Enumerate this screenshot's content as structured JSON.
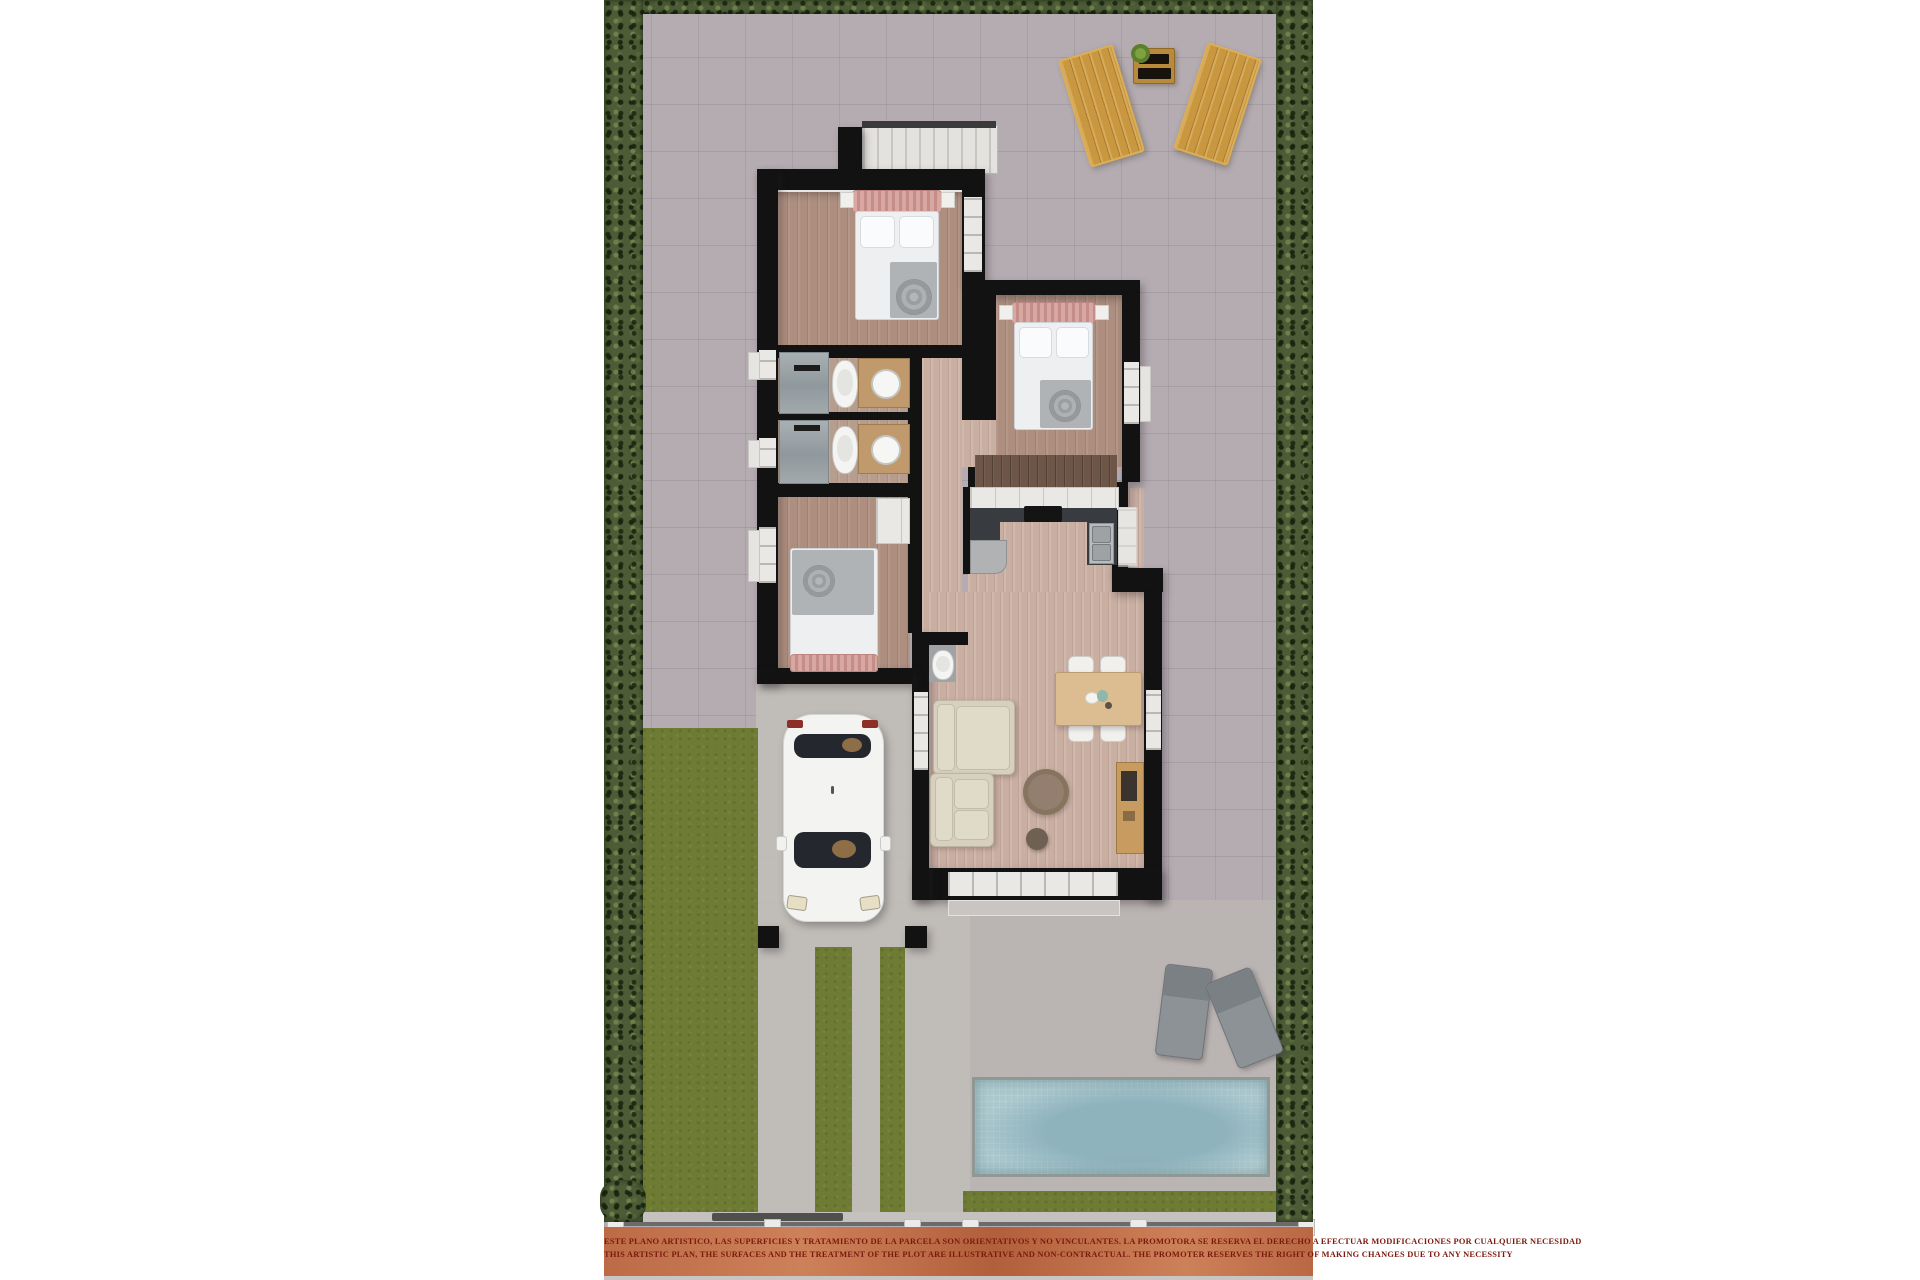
{
  "meta": {
    "type": "architectural-floor-plan-render",
    "view": "top-down-3d",
    "subject": "single-storey villa with garden, driveway, car and pool"
  },
  "disclaimer": {
    "line1": "ESTE PLANO ARTISTICO, LAS SUPERFICIES Y TRATAMIENTO DE LA PARCELA SON ORIENTATIVOS Y NO VINCULANTES. LA PROMOTORA SE RESERVA EL DERECHO A EFECTUAR MODIFICACIONES POR CUALQUIER NECESIDAD",
    "line2": "THIS ARTISTIC PLAN, THE SURFACES AND THE TREATMENT OF THE PLOT ARE ILLUSTRATIVE AND NON-CONTRACTUAL. THE PROMOTER RESERVES THE RIGHT OF MAKING CHANGES DUE TO ANY NECESSITY"
  },
  "palette": {
    "page-bg": "#ffffff",
    "pavement": "#b4acb1",
    "pavement-light": "#c1bdb9",
    "hedge": "#4d5c37",
    "lawn": "#6e7b33",
    "pool-water": "#a5c3ca",
    "brick": "#c1714b",
    "disclaimer-color": "#7c190f",
    "wall": "#121212",
    "outdoor-wood": "#c9973f",
    "sofa": "#d7d0bf",
    "table-wood": "#dcbd92",
    "car-body": "#f3f3f1"
  }
}
